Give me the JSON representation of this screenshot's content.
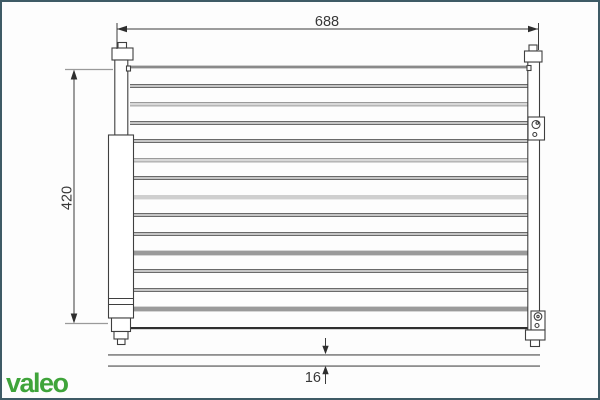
{
  "frame": {
    "border_color": "#3e5b66",
    "background": "#fdfdfd"
  },
  "logo": {
    "text": "valeo",
    "color": "#3fa43a"
  },
  "dimensions": {
    "width_label": "688",
    "height_label": "420",
    "depth_label": "16"
  },
  "diagram": {
    "core": {
      "x1": 130,
      "x2": 528,
      "top": 67,
      "bottom": 328
    },
    "tube_rows": [
      {
        "y": 67,
        "style": "edge"
      },
      {
        "y": 86,
        "style": "double"
      },
      {
        "y": 104,
        "style": "band"
      },
      {
        "y": 123,
        "style": "double"
      },
      {
        "y": 141,
        "style": "double"
      },
      {
        "y": 160,
        "style": "band"
      },
      {
        "y": 178,
        "style": "double"
      },
      {
        "y": 197,
        "style": "band-light"
      },
      {
        "y": 215,
        "style": "double"
      },
      {
        "y": 234,
        "style": "double"
      },
      {
        "y": 253,
        "style": "bar"
      },
      {
        "y": 271,
        "style": "double"
      },
      {
        "y": 290,
        "style": "double"
      },
      {
        "y": 309,
        "style": "bar"
      },
      {
        "y": 328,
        "style": "bottom"
      }
    ],
    "colors": {
      "line": "#474747",
      "gray": "#9a9a9a",
      "light": "#d8d8d8",
      "lighter": "#cfcfcf",
      "edge": "#8a8a8a",
      "dark": "#2f2f2f",
      "bottom_view": "#8f8f8f"
    }
  }
}
